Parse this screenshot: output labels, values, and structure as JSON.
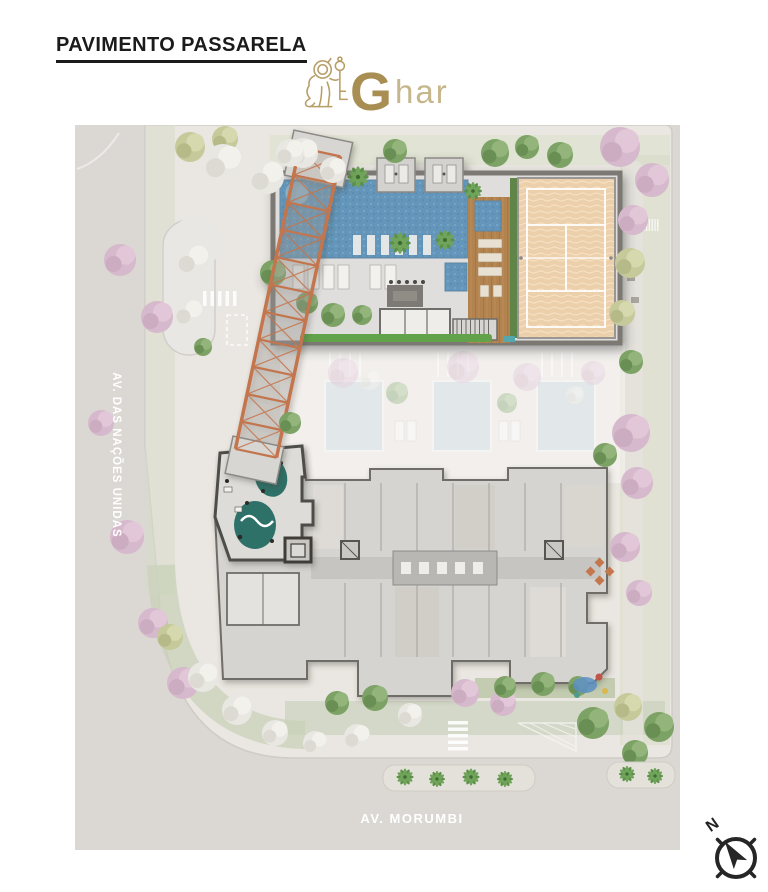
{
  "page": {
    "title": "PAVIMENTO PASSARELA"
  },
  "brand": {
    "initial": "G",
    "rest": "har",
    "icon": "lion-and-key"
  },
  "plan": {
    "street_left": "AV. DAS NAÇÕES UNIDAS",
    "street_bottom": "AV. MORUMBI"
  },
  "compass": {
    "north_label": "N"
  },
  "colors": {
    "brand_gold": "#b79d66",
    "pool_water": "#6496ba",
    "beach_court_sand": "#eccfab",
    "wood_deck": "#b2824f",
    "passarela_truss": "#c3754d",
    "lawn_green": "#62a24b",
    "lounge_rug_teal": "#2f7168",
    "street_gray": "#dbd7d3",
    "sidewalk": "#eae6e1",
    "building_gray": "#d6d4d0",
    "tree_pink": "#d6b9cc",
    "tree_green": "#7da265"
  }
}
